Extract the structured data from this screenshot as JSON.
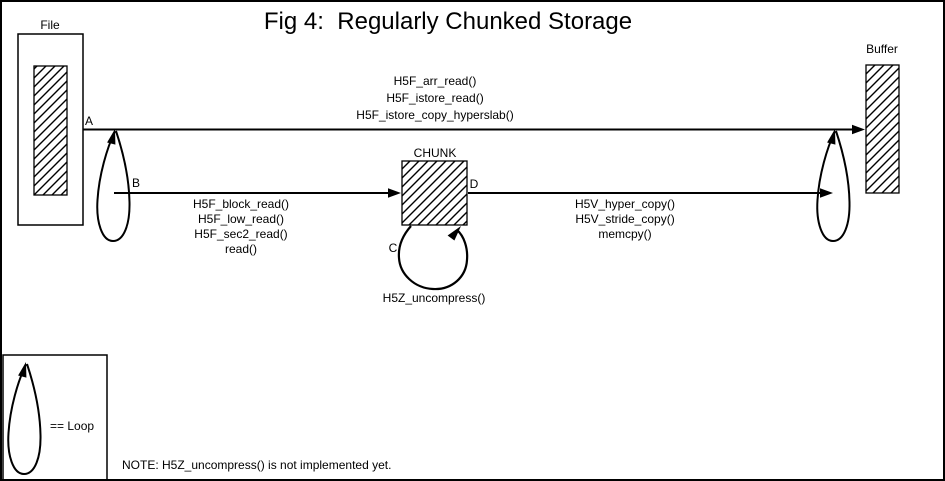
{
  "figure": {
    "title": "Fig 4:  Regularly Chunked Storage",
    "note": "NOTE: H5Z_uncompress() is not implemented yet."
  },
  "colors": {
    "ink": "#000000",
    "paper": "#ffffff"
  },
  "nodes": {
    "file": {
      "label": "File"
    },
    "buffer": {
      "label": "Buffer"
    },
    "chunk": {
      "label": "CHUNK"
    }
  },
  "edges": {
    "a": {
      "label": "A",
      "functions": [
        "H5F_arr_read()",
        "H5F_istore_read()",
        "H5F_istore_copy_hyperslab()"
      ]
    },
    "b": {
      "label": "B",
      "functions": [
        "H5F_block_read()",
        "H5F_low_read()",
        "H5F_sec2_read()",
        "read()"
      ]
    },
    "c": {
      "label": "C",
      "functions": [
        "H5Z_uncompress()"
      ]
    },
    "d": {
      "label": "D",
      "functions": [
        "H5V_hyper_copy()",
        "H5V_stride_copy()",
        "memcpy()"
      ]
    }
  },
  "legend": {
    "label": "== Loop"
  }
}
